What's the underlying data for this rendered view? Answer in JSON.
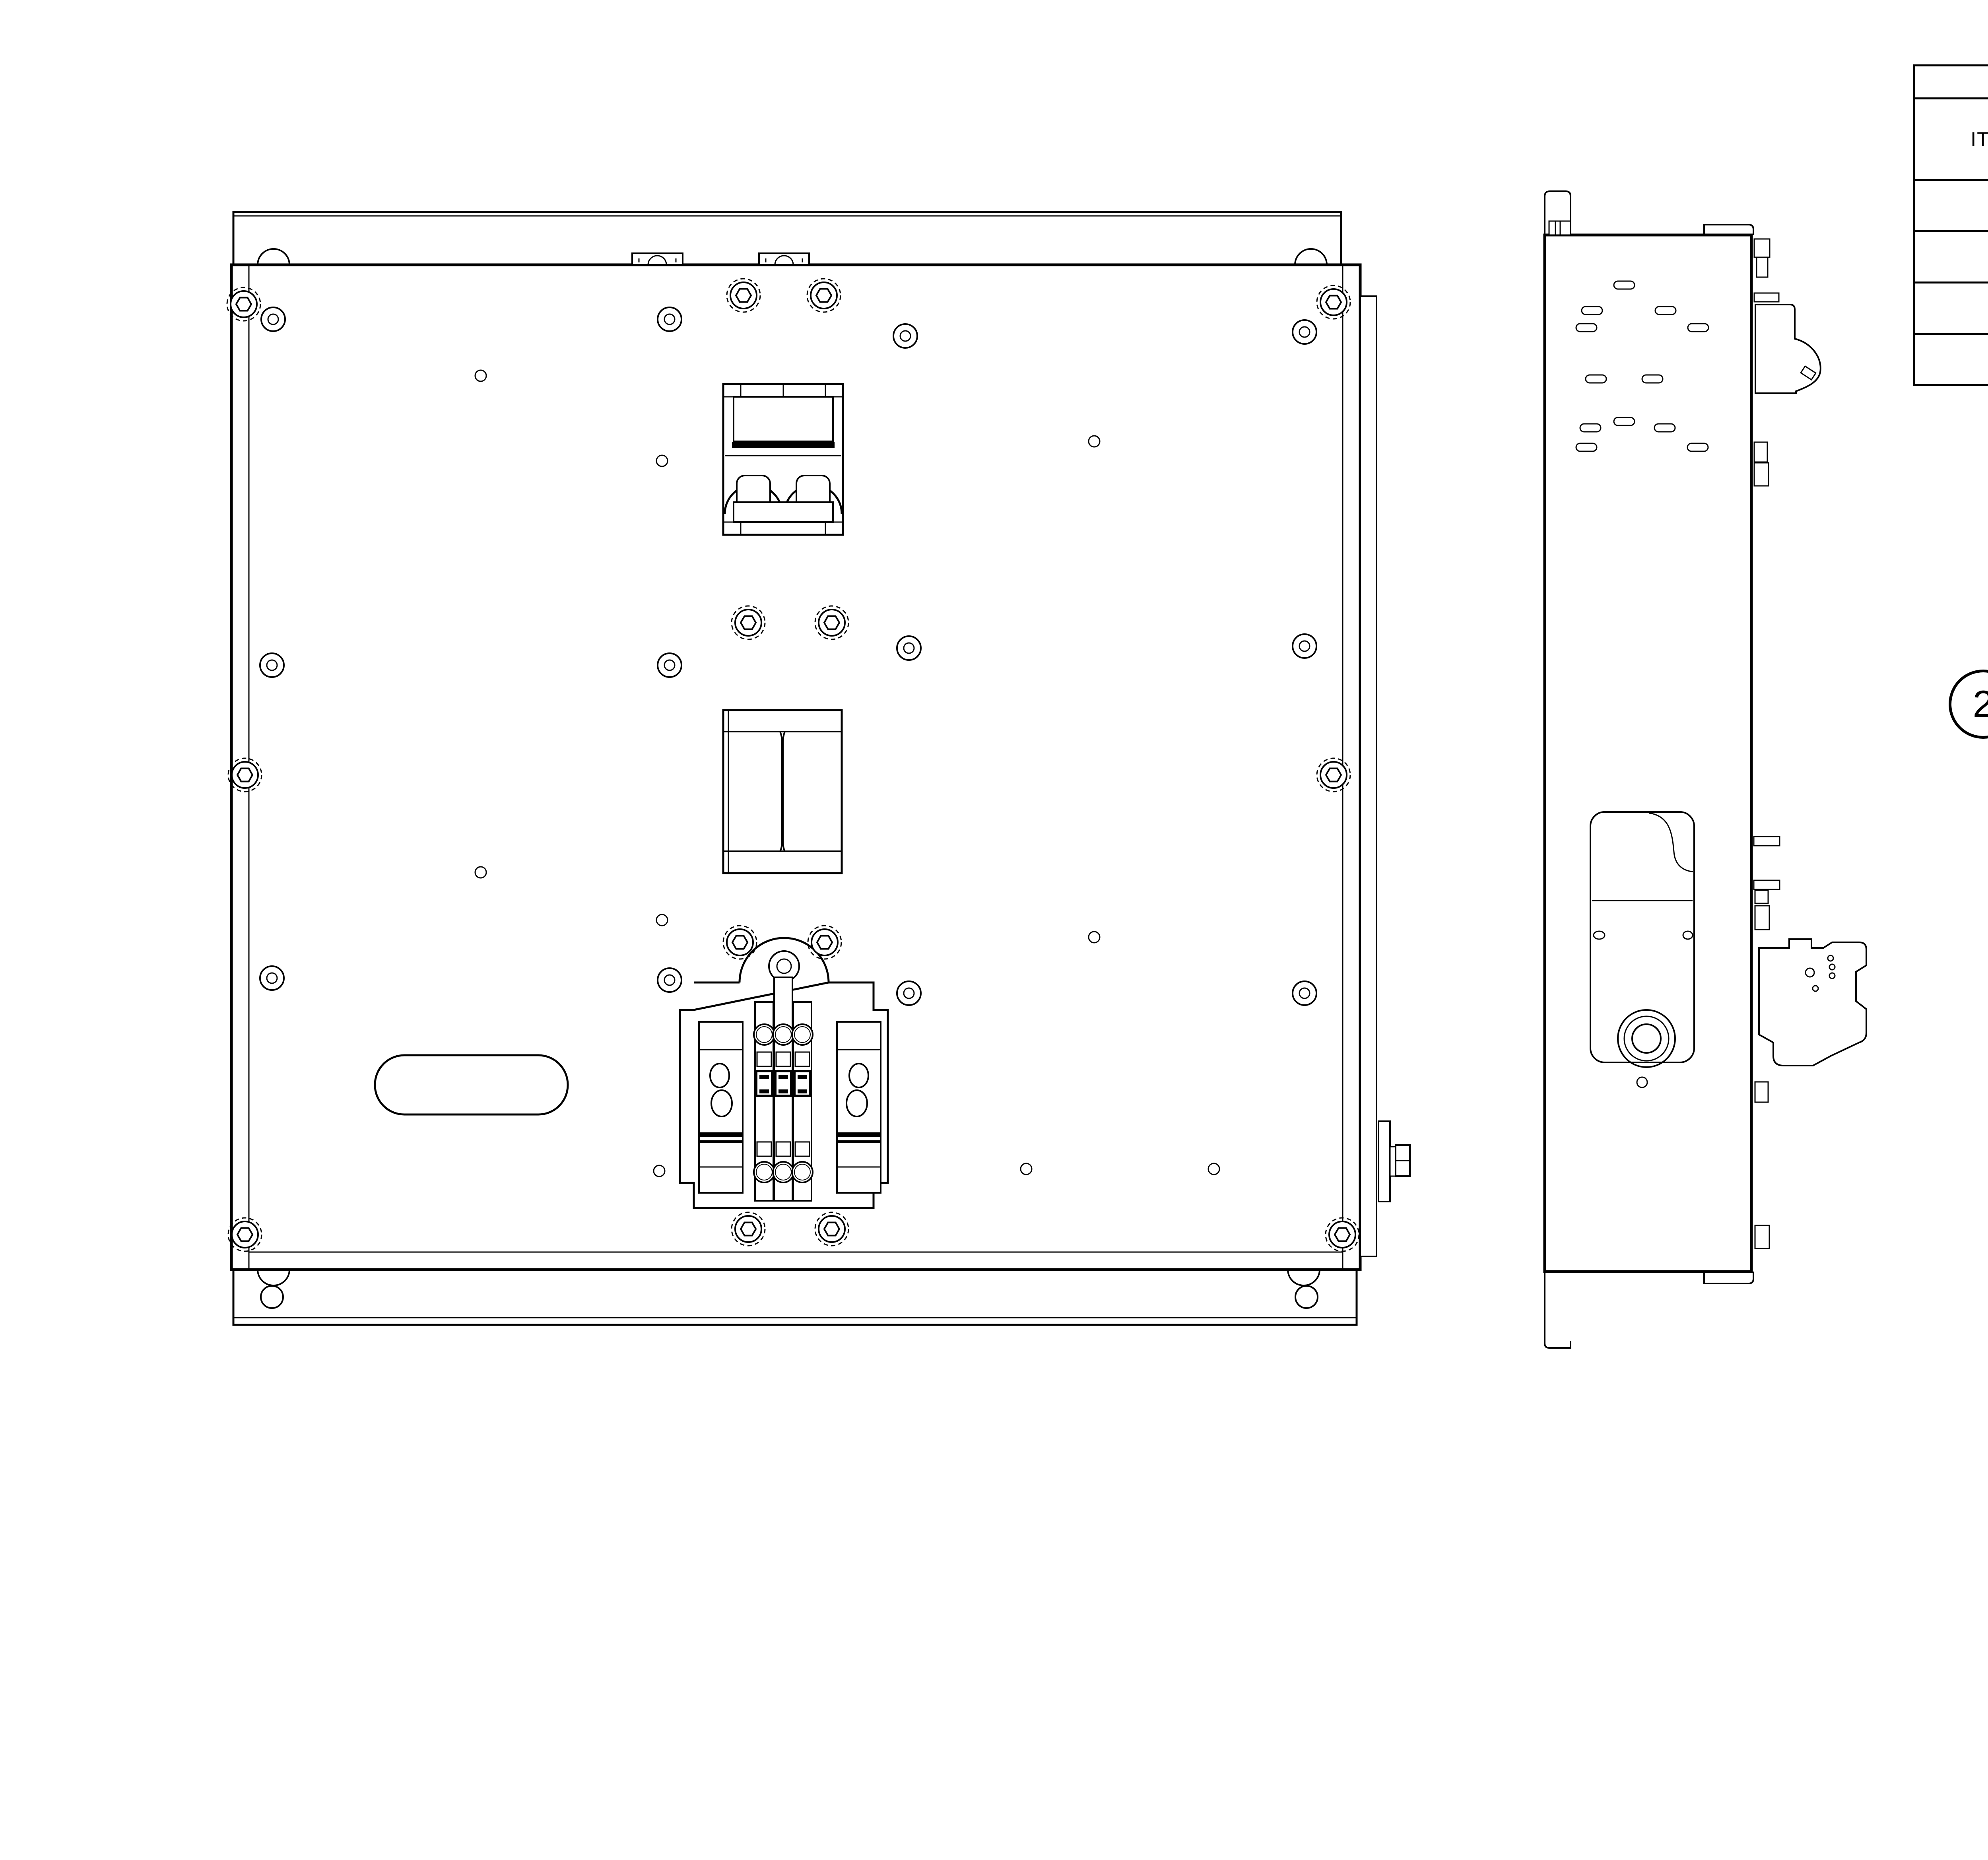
{
  "document": {
    "kind": "mechanical assembly drawing",
    "background": "#ffffff"
  },
  "parts_list": {
    "title": "PARTS LIST",
    "columns": {
      "item": "ITEM",
      "qty": "QTY",
      "part_number": "PART NUMBER",
      "description": "DESCRIPTION"
    },
    "rows": [
      {
        "item": "1",
        "qty": "1",
        "part_number": "600-917",
        "description": "QUINT-PS/ 1VAC/24VDC/10"
      },
      {
        "item": "2",
        "qty": "1",
        "part_number": "901-023",
        "description": "Top Plate for NLC"
      },
      {
        "item": "3",
        "qty": "1",
        "part_number": "901-020",
        "description": "Bottom plate assembly NLC"
      },
      {
        "item": "4",
        "qty": "1",
        "part_number": "600-928",
        "description": "Automatsikring 6A"
      }
    ]
  },
  "balloons": [
    {
      "label": "3"
    },
    {
      "label": "1"
    },
    {
      "label": "4"
    },
    {
      "label": "2"
    }
  ],
  "views": {
    "front": "front view - bottom plate assembly",
    "side": "side view",
    "exploded": "exploded isometric view",
    "assembled": "assembled isometric view"
  },
  "colors": {
    "line": "#000000",
    "background": "#ffffff",
    "plate_gray": "#c6c6c6",
    "plate_gray_light": "#dedede",
    "plate_gray_dark": "#a9a9a9",
    "psu_black": "#2e2e2e",
    "terminal_green": "#2ec82e",
    "signal_green": "#17e617",
    "connector_green": "#3cb44a",
    "terminal_pink": "#c89b9b",
    "clip_tan": "#d8c79e"
  }
}
